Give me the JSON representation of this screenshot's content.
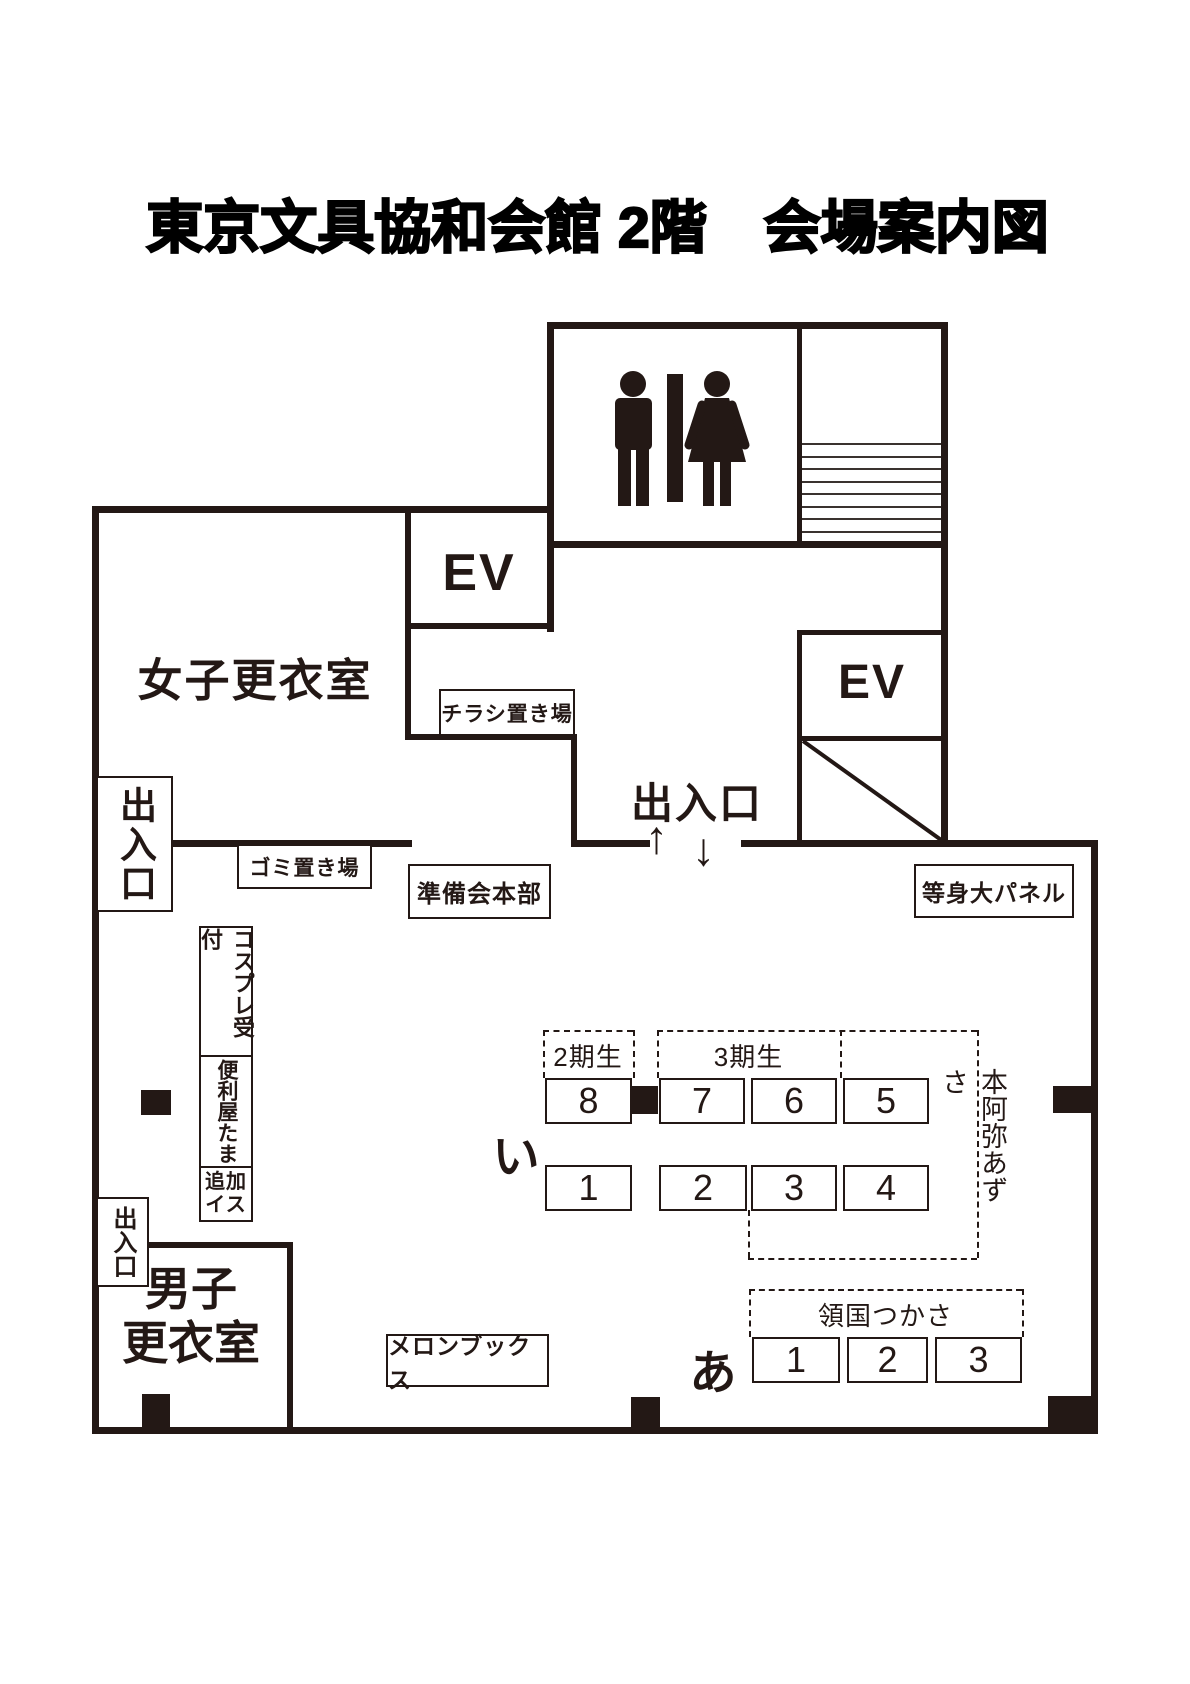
{
  "title": "東京文具協和会館 2階　会場案内図",
  "colors": {
    "ink": "#231815",
    "background": "#ffffff"
  },
  "rooms": {
    "womens_changing_room": "女子更衣室",
    "mens_changing_room_line1": "男子",
    "mens_changing_room_line2": "更衣室",
    "elevator_1": "EV",
    "elevator_2": "EV"
  },
  "entrances": {
    "main_entrance": "出入口",
    "main_entrance_arrow_up": "↑",
    "main_entrance_arrow_down": "↓",
    "left_upper_entrance": "出入口",
    "left_lower_entrance": "出入口"
  },
  "stations": {
    "flyer_area": "チラシ置き場",
    "garbage_area": "ゴミ置き場",
    "staff_headquarters": "準備会本部",
    "life_size_panel": "等身大パネル",
    "melonbooks": "メロンブックス",
    "cosplay_reception": "コスプレ受付",
    "benriya_tama": "便利屋たま",
    "extra_chairs_line1": "追加",
    "extra_chairs_line2": "イス"
  },
  "booth_area": {
    "row_label_i": "い",
    "row_label_a": "あ",
    "group_gen2": "2期生",
    "group_gen3": "3期生",
    "name_honami_azusa": "本阿弥あずさ",
    "name_ryogoku_tsukasa": "領国つかさ",
    "tables": {
      "row_i_top": [
        "8",
        "7",
        "6",
        "5"
      ],
      "row_i_bottom": [
        "1",
        "2",
        "3",
        "4"
      ],
      "row_a": [
        "1",
        "2",
        "3"
      ]
    }
  }
}
